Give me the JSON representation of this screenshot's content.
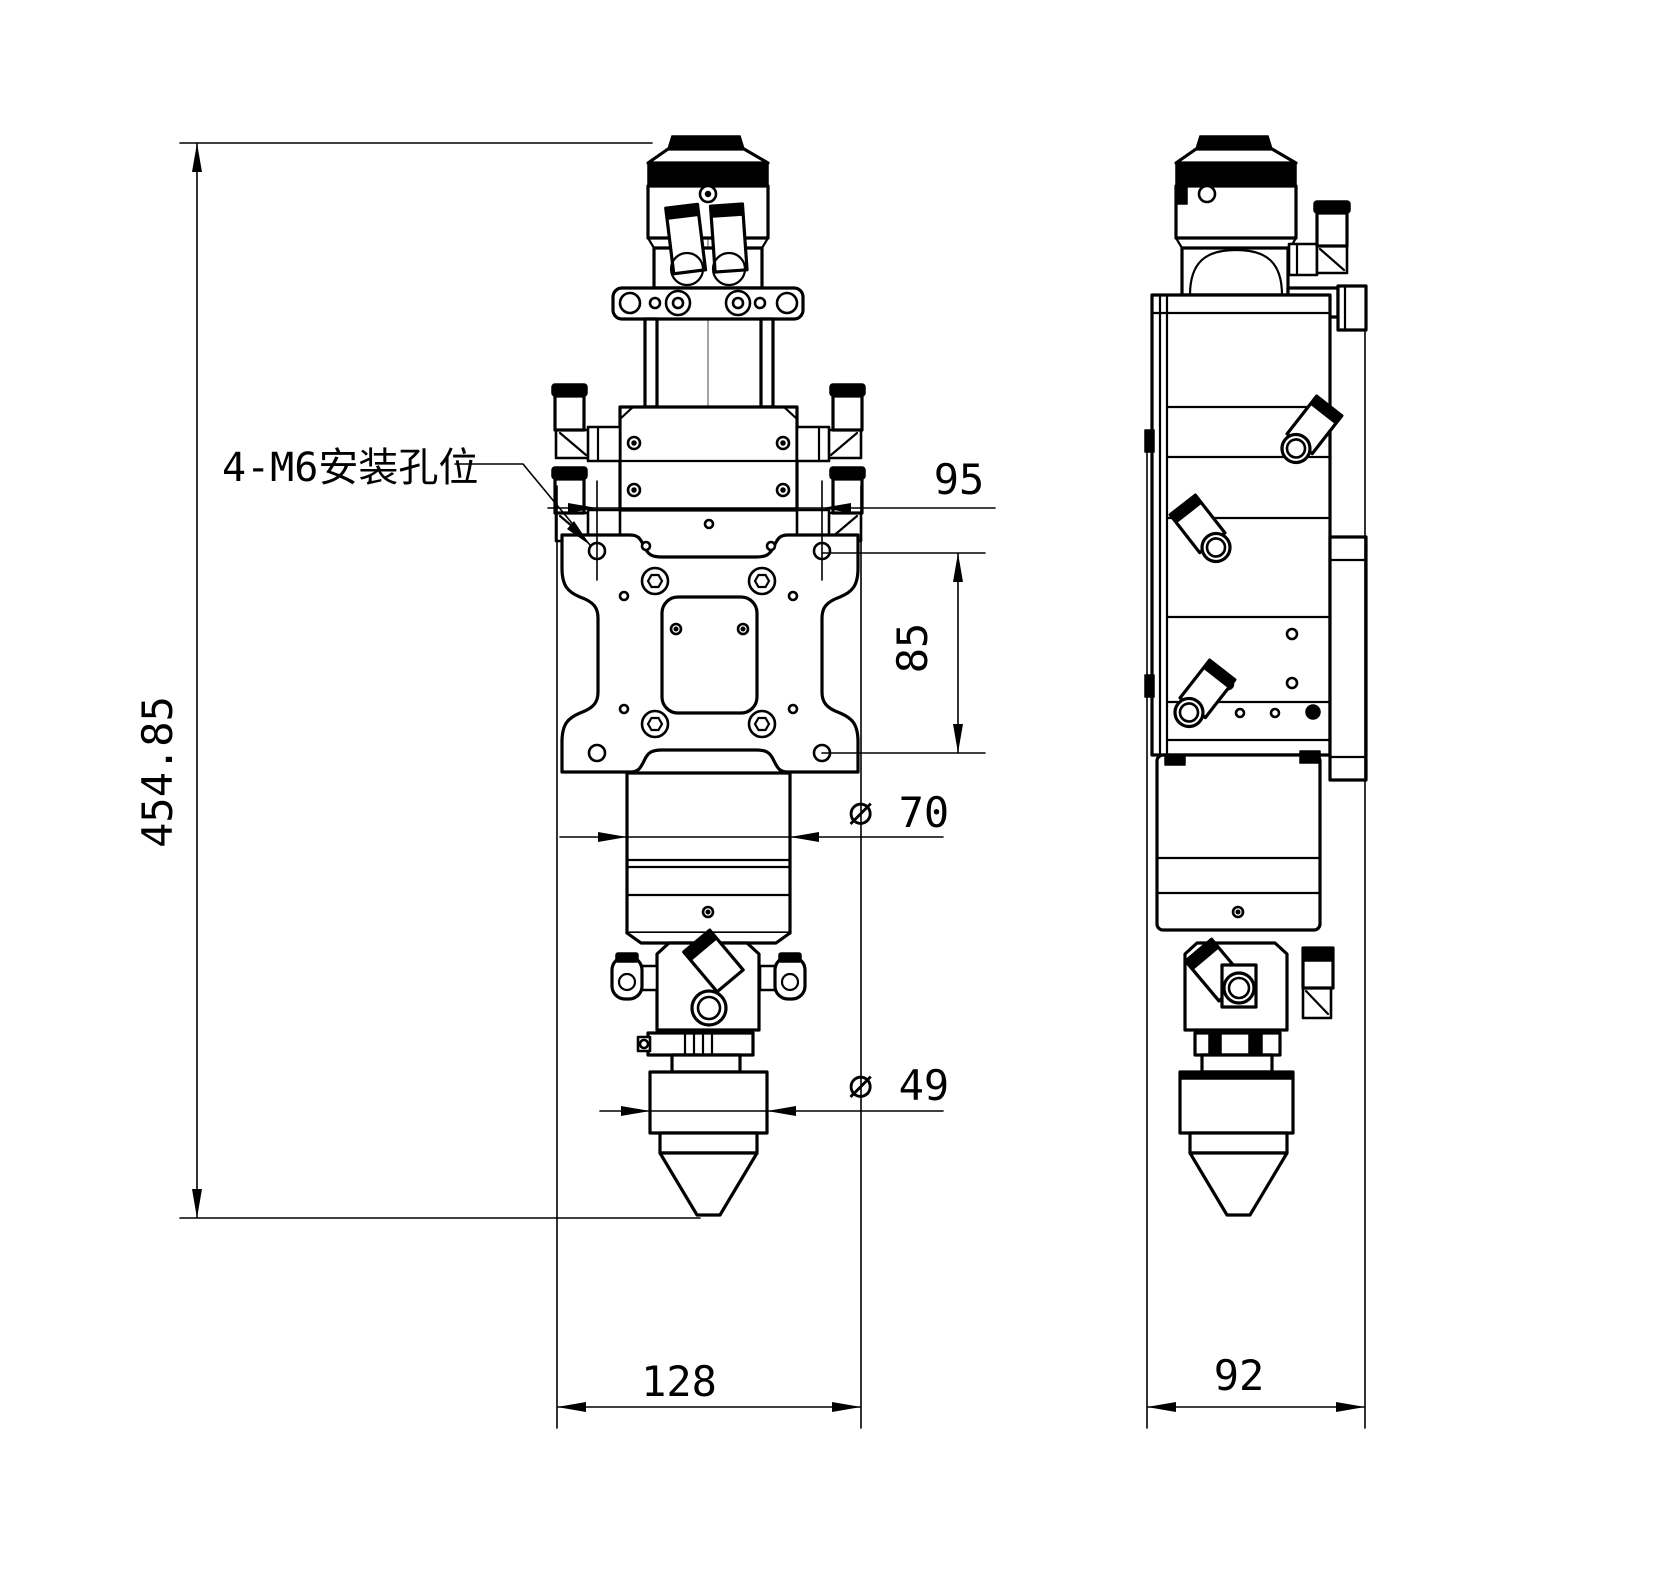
{
  "drawing": {
    "annotation": {
      "mounting_holes_label": "4-M6安装孔位"
    },
    "dimensions": {
      "overall_height": "454.85",
      "hole_spacing_horizontal": "95",
      "hole_spacing_vertical": "85",
      "body_diameter_label": "∅ 70",
      "nozzle_diameter_label": "∅ 49",
      "front_width": "128",
      "side_width": "92"
    },
    "colors": {
      "line": "#000000",
      "centerline": "#9a9a9a",
      "background": "#ffffff"
    }
  }
}
